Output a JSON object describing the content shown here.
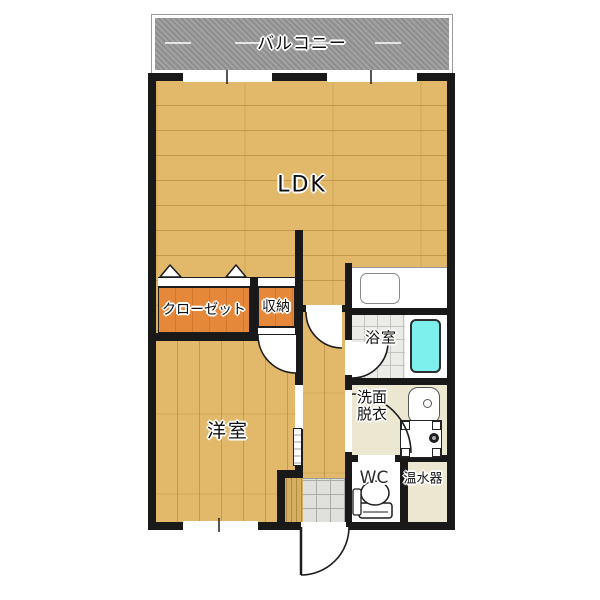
{
  "meta": {
    "kind": "apartment-floor-plan"
  },
  "colors": {
    "wall": "#191919",
    "wood": "#e2b96a",
    "woodLine": "rgba(145,95,25,0.35)",
    "orange": "#e6883a",
    "balcony": "#9c9c9c",
    "bathTile": "#ebebe8",
    "tileLine": "#c4c4c0",
    "beige": "#ebe7d0",
    "tub": "#7df0ee",
    "entranceTile": "#e0e0dd",
    "step": "#d6ae62"
  },
  "rooms": {
    "balcony": {
      "label": "バルコニー"
    },
    "ldk": {
      "label": "LDK"
    },
    "closet": {
      "label": "クローゼット"
    },
    "storage": {
      "label": "収納"
    },
    "western_room": {
      "label": "洋室"
    },
    "bathroom": {
      "label": "浴室"
    },
    "washroom": {
      "label_line1": "洗面",
      "label_line2": "脱衣"
    },
    "wc": {
      "label": "WC"
    },
    "water_heater": {
      "label": "温水器"
    }
  }
}
